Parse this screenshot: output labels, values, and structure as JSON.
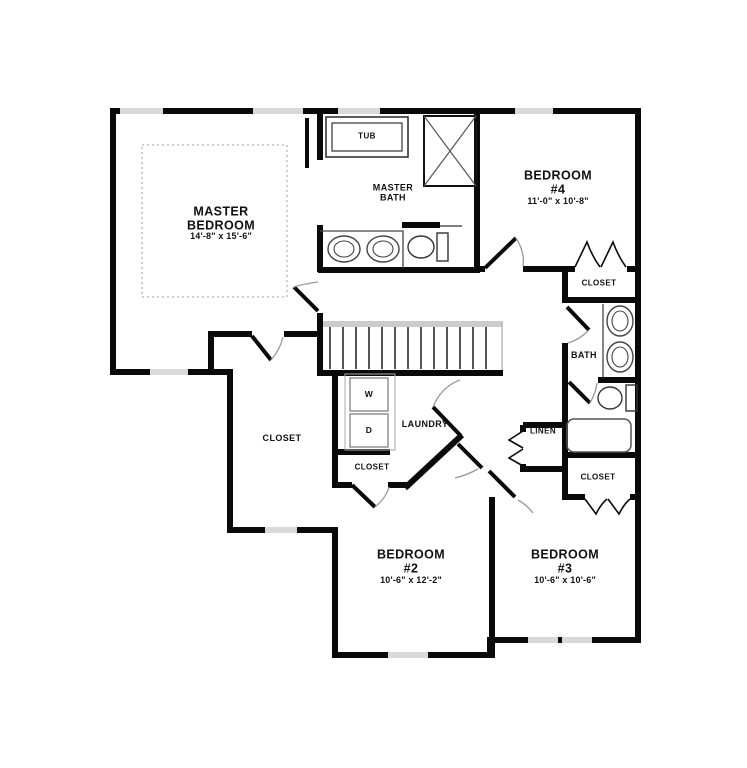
{
  "rooms": {
    "master_bedroom": {
      "name": "MASTER BEDROOM",
      "dims": "14'-8\" x 15'-6\""
    },
    "master_bath": {
      "name": "MASTER BATH"
    },
    "tub": {
      "name": "TUB"
    },
    "bedroom4": {
      "name": "BEDROOM #4",
      "dims": "11'-0\" x 10'-8\""
    },
    "bedroom2": {
      "name": "BEDROOM #2",
      "dims": "10'-6\" x 12'-2\""
    },
    "bedroom3": {
      "name": "BEDROOM #3",
      "dims": "10'-6\" x 10'-6\""
    },
    "bath": {
      "name": "BATH"
    },
    "laundry": {
      "name": "LAUNDRY"
    },
    "linen": {
      "name": "LINEN"
    },
    "closet_master": {
      "name": "CLOSET"
    },
    "closet_bedroom4": {
      "name": "CLOSET"
    },
    "closet_bath": {
      "name": "CLOSET"
    },
    "closet_bedroom2": {
      "name": "CLOSET"
    },
    "washer": "W",
    "dryer": "D"
  },
  "colors": {
    "wall": "#0a0a0a",
    "window": "#d9d9d9",
    "door_arc": "#999999",
    "fixture": "#444444",
    "tray_ceiling": "#b3b3b3",
    "background": "#ffffff"
  }
}
